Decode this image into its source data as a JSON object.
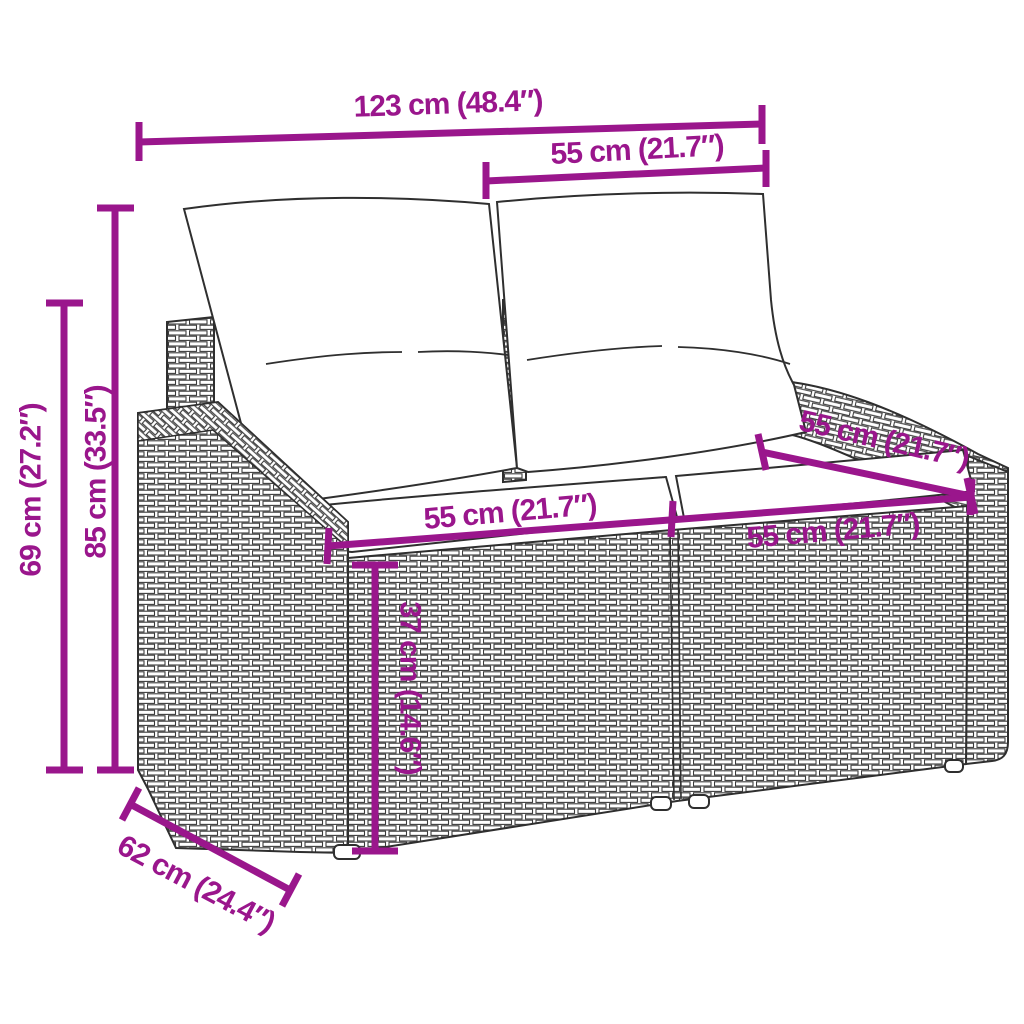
{
  "diagram": {
    "type": "product-dimension-diagram",
    "subject": "poly-rattan 2-seater garden sofa with back and seat cushions",
    "dimensions": [
      {
        "id": "overall-width",
        "label": "123 cm (48.4″)",
        "cm": 123,
        "inches": 48.4,
        "orientation": "horizontal"
      },
      {
        "id": "back-section-width",
        "label": "55 cm (21.7″)",
        "cm": 55,
        "inches": 21.7,
        "orientation": "horizontal"
      },
      {
        "id": "total-height",
        "label": "85 cm (33.5″)",
        "cm": 85,
        "inches": 33.5,
        "orientation": "vertical"
      },
      {
        "id": "armrest-height",
        "label": "69 cm (27.2″)",
        "cm": 69,
        "inches": 27.2,
        "orientation": "vertical"
      },
      {
        "id": "seat-width-left",
        "label": "55 cm (21.7″)",
        "cm": 55,
        "inches": 21.7,
        "orientation": "horizontal"
      },
      {
        "id": "seat-width-right",
        "label": "55 cm (21.7″)",
        "cm": 55,
        "inches": 21.7,
        "orientation": "horizontal"
      },
      {
        "id": "backrest-edge-right",
        "label": "55 cm (21.7″)",
        "cm": 55,
        "inches": 21.7,
        "orientation": "diagonal"
      },
      {
        "id": "seat-height",
        "label": "37 cm (14.6″)",
        "cm": 37,
        "inches": 14.6,
        "orientation": "vertical"
      },
      {
        "id": "depth",
        "label": "62 cm (24.4″)",
        "cm": 62,
        "inches": 24.4,
        "orientation": "diagonal"
      }
    ]
  },
  "colors": {
    "dimension": "#9a168c",
    "line_art": "#2f2f2f",
    "background": "#ffffff",
    "cushion_fill": "#ffffff"
  }
}
